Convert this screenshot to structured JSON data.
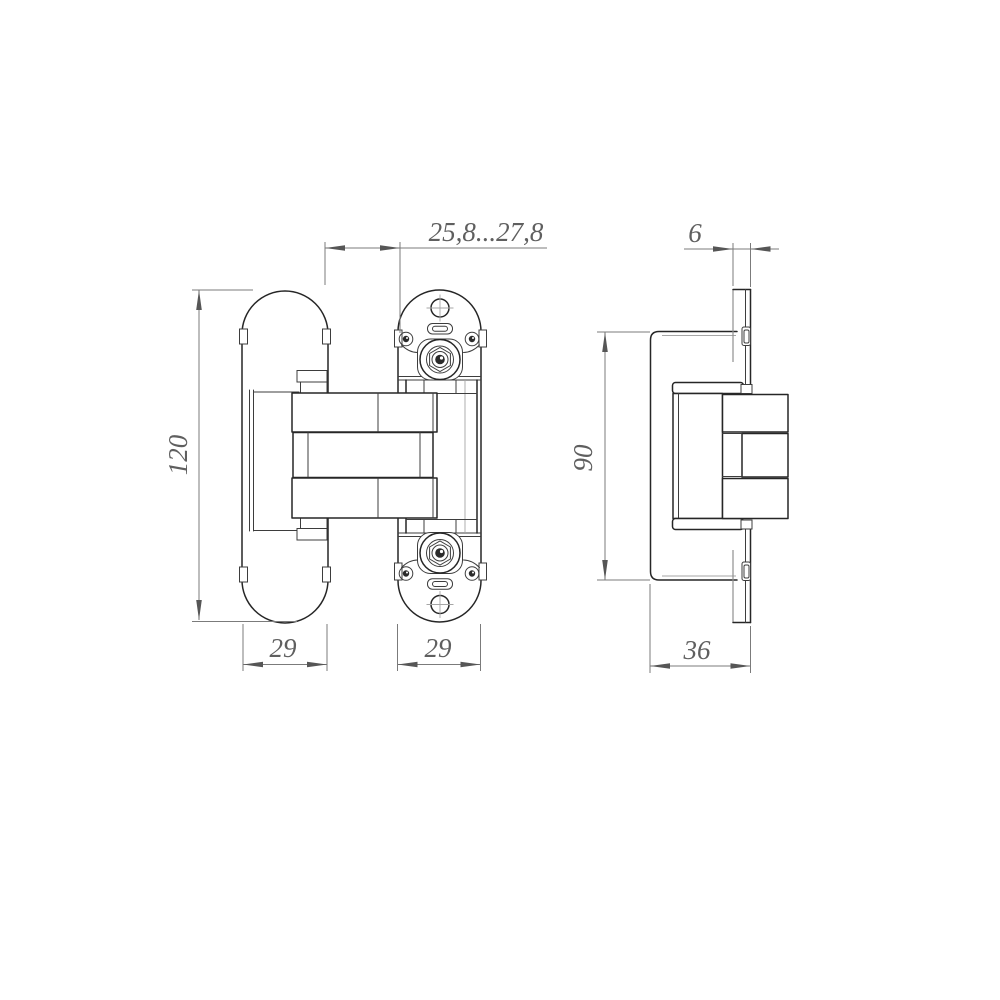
{
  "drawing": {
    "type": "technical-drawing",
    "subject": "concealed-door-hinge",
    "units_style": "comma-decimal",
    "colors": {
      "background": "#ffffff",
      "object_line": "#262626",
      "dimension_line": "#7b7b7b",
      "dimension_text": "#5f5f5f"
    },
    "views": [
      {
        "id": "front",
        "name": "front-view",
        "dimensions": [
          {
            "id": "gap_width",
            "label": "25,8...27,8"
          },
          {
            "id": "overall_height",
            "label": "120"
          },
          {
            "id": "left_plate_width",
            "label": "29"
          },
          {
            "id": "right_plate_width",
            "label": "29"
          }
        ]
      },
      {
        "id": "side",
        "name": "side-view",
        "dimensions": [
          {
            "id": "plate_thickness",
            "label": "6"
          },
          {
            "id": "mortise_height",
            "label": "90"
          },
          {
            "id": "overall_depth",
            "label": "36"
          }
        ]
      }
    ]
  }
}
